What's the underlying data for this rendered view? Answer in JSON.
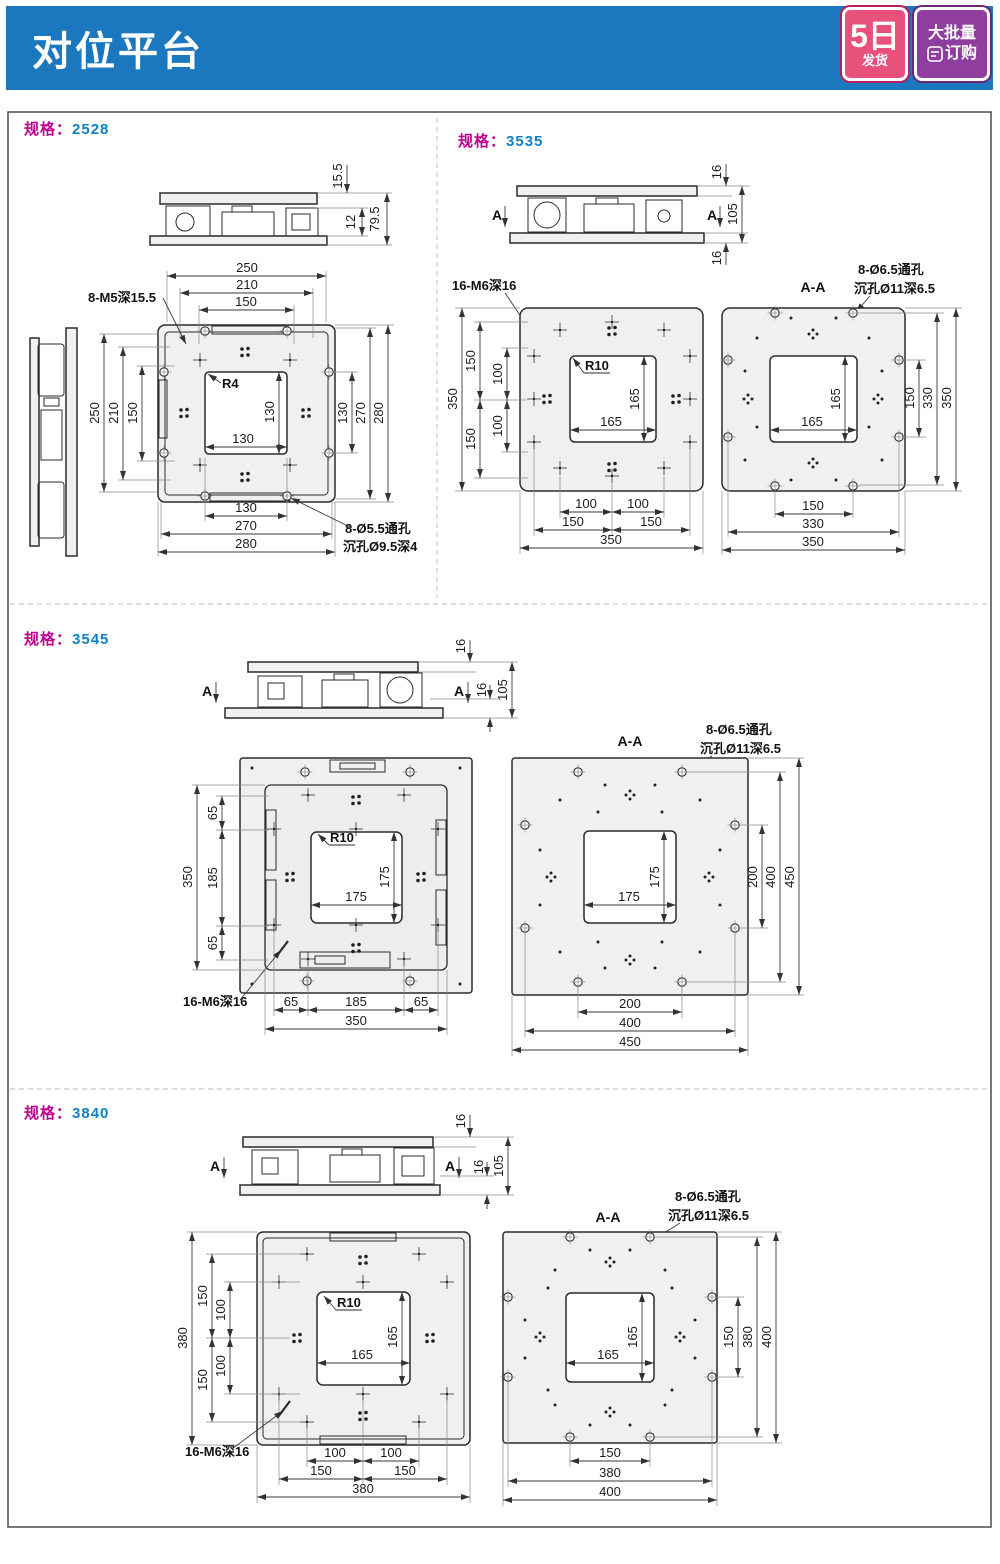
{
  "header": {
    "title": "对位平台",
    "badge_fast": {
      "big": "5日",
      "small": "发货"
    },
    "badge_bulk": {
      "line1": "大批量",
      "line2": "订购"
    }
  },
  "spec_prefix": "规格",
  "spec_sep": "：",
  "colors": {
    "header_bg": "#1b78be",
    "spec_magenta": "#c0008c",
    "spec_number_blue": "#0e82c8",
    "badge_pink": "#e8517c",
    "badge_purple": "#8f3d9e",
    "line": "#2b2b2b",
    "plate_fill": "#f0f0f0"
  },
  "d2528": {
    "spec": "2528",
    "side": {
      "a": "15.5",
      "b": "12",
      "c": "79.5"
    },
    "thread": "8-M5深15.5",
    "r": "R4",
    "hole1": "8-Ø5.5通孔",
    "hole2": "沉孔Ø9.5深4",
    "top": [
      "250",
      "210",
      "150"
    ],
    "left": [
      "250",
      "210",
      "150"
    ],
    "right": [
      "130",
      "270",
      "280"
    ],
    "bottom": [
      "130",
      "270",
      "280"
    ],
    "inner": [
      "130",
      "130"
    ]
  },
  "d3535": {
    "spec": "3535",
    "side": {
      "a": "16",
      "b": "105",
      "c": "16",
      "mark": "A"
    },
    "thread": "16-M6深16",
    "r": "R10",
    "section": "A-A",
    "hole1": "8-Ø6.5通孔",
    "hole2": "沉孔Ø11深6.5",
    "L": {
      "total": "350",
      "left": [
        "150",
        "100",
        "100",
        "150"
      ],
      "bottom": [
        "100",
        "100",
        "150",
        "150",
        "350"
      ],
      "inner": [
        "165",
        "165"
      ]
    },
    "R": {
      "right": [
        "150",
        "330",
        "350"
      ],
      "bottom": [
        "150",
        "330",
        "350"
      ],
      "inner": [
        "165",
        "165"
      ]
    }
  },
  "d3545": {
    "spec": "3545",
    "side": {
      "a": "16",
      "b": "16",
      "c": "105",
      "mark": "A"
    },
    "thread": "16-M6深16",
    "r": "R10",
    "section": "A-A",
    "hole1": "8-Ø6.5通孔",
    "hole2": "沉孔Ø11深6.5",
    "L": {
      "total": "350",
      "left": [
        "65",
        "185",
        "65"
      ],
      "bottom": [
        "65",
        "185",
        "65",
        "350"
      ],
      "inner": [
        "175",
        "175"
      ]
    },
    "R": {
      "right": [
        "200",
        "400",
        "450"
      ],
      "bottom": [
        "200",
        "400",
        "450"
      ],
      "inner": [
        "175",
        "175"
      ]
    }
  },
  "d3840": {
    "spec": "3840",
    "side": {
      "a": "16",
      "b": "16",
      "c": "105",
      "mark": "A"
    },
    "thread": "16-M6深16",
    "r": "R10",
    "section": "A-A",
    "hole1": "8-Ø6.5通孔",
    "hole2": "沉孔Ø11深6.5",
    "L": {
      "total": "380",
      "left": [
        "150",
        "100",
        "100",
        "150"
      ],
      "bottom": [
        "100",
        "100",
        "150",
        "150",
        "380"
      ],
      "inner": [
        "165",
        "165"
      ]
    },
    "R": {
      "right": [
        "150",
        "380",
        "400"
      ],
      "bottom": [
        "150",
        "380",
        "400"
      ],
      "inner": [
        "165",
        "165"
      ]
    }
  }
}
